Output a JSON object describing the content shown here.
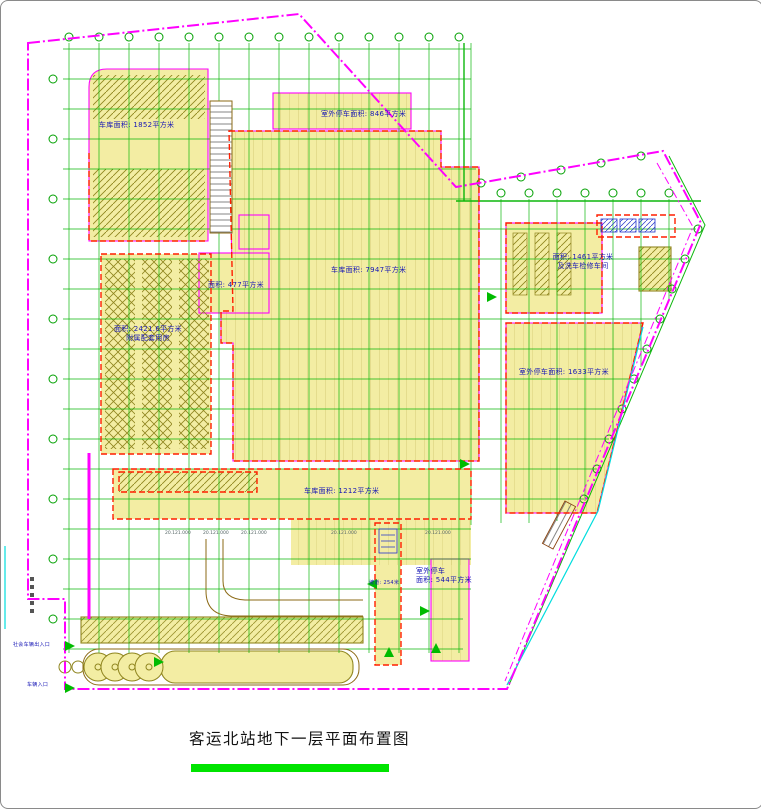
{
  "drawing": {
    "title": "客运北站地下一层平面布置图",
    "areas": {
      "garage_topleft": {
        "label": "车库面积: 1852平方米"
      },
      "outdoor_top": {
        "label": "室外停车面积: 846平方米"
      },
      "garage_center": {
        "label": "车库面积: 7947平方米"
      },
      "room_477": {
        "label": "面积: 477平方米"
      },
      "annex_left": {
        "line1": "面积: 2421.6平方米",
        "line2": "附属配套用房"
      },
      "depot_right": {
        "line1": "面积: 1461平方米",
        "line2": "及洗车检修车间"
      },
      "outdoor_right": {
        "label": "室外停车面积: 1633平方米"
      },
      "garage_south": {
        "label": "车库面积: 1212平方米"
      },
      "outdoor_southeast": {
        "line1": "室外停车",
        "line2": "面积: 544平方米"
      },
      "ramp": {
        "label": "坡道: 254米"
      }
    },
    "entrances": {
      "social_vehicle": "社会车辆出入口",
      "vehicle": "车辆入口"
    },
    "elevation_stamp": "20.121.000",
    "colors": {
      "boundary": "#FF00FF",
      "grid": "#00B400",
      "area_fill": "#F3EDA3",
      "fire_compartment": "#FF1E00",
      "hatch": "#8F851F",
      "label_text": "#1515B5",
      "title_underline": "#00E400",
      "utility": "#00DDDD",
      "road": "#8B6914"
    }
  }
}
